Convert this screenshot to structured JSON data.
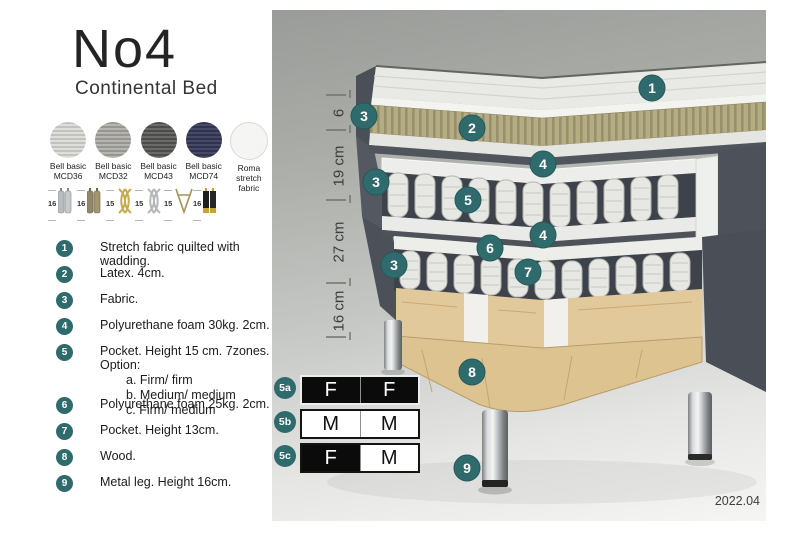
{
  "header": {
    "title": "No4",
    "subtitle": "Continental Bed"
  },
  "colors": {
    "accent_teal": "#2f6b6c",
    "panel_top_gray": "#999c98",
    "latex_khaki": "#b4ac83",
    "wood": "#dcc390",
    "bed_fabric_dark": "#4d525a"
  },
  "fabrics": [
    {
      "line1": "Bell basic",
      "line2": "MCD36",
      "color": "#d0d0cc"
    },
    {
      "line1": "Bell basic",
      "line2": "MCD32",
      "color": "#a5a5a0"
    },
    {
      "line1": "Bell basic",
      "line2": "MCD43",
      "color": "#595a57"
    },
    {
      "line1": "Bell basic",
      "line2": "MCD74",
      "color": "#3a3d58"
    },
    {
      "line1": "Roma",
      "line2": "stretch fabric",
      "color": "#f5f5f3"
    }
  ],
  "legs": [
    {
      "size": "16",
      "icon": "chrome-cylinder-legs"
    },
    {
      "size": "16",
      "icon": "bronze-cylinder-legs"
    },
    {
      "size": "15",
      "icon": "gold-twist-leg"
    },
    {
      "size": "15",
      "icon": "silver-twist-leg"
    },
    {
      "size": "15",
      "icon": "hairpin-leg"
    },
    {
      "size": "16",
      "icon": "black-gold-legs"
    }
  ],
  "callouts": [
    {
      "num": "1",
      "text": "Stretch fabric quilted with wadding."
    },
    {
      "num": "2",
      "text": "Latex. 4cm."
    },
    {
      "num": "3",
      "text": "Fabric."
    },
    {
      "num": "4",
      "text": "Polyurethane foam 30kg. 2cm."
    },
    {
      "num": "5",
      "text": "Pocket. Height 15 cm. 7zones. Option:",
      "options": [
        "a. Firm/ firm",
        "b. Medium/ medium",
        "c. Firm/ medium"
      ]
    },
    {
      "num": "6",
      "text": "Polyurethane foam 25kg. 2cm."
    },
    {
      "num": "7",
      "text": "Pocket. Height 13cm."
    },
    {
      "num": "8",
      "text": "Wood."
    },
    {
      "num": "9",
      "text": "Metal leg. Height 16cm."
    }
  ],
  "diagram": {
    "badges": {
      "b1": "1",
      "b2": "2",
      "b3": "3",
      "b4": "4",
      "b5": "5",
      "b6": "6",
      "b7": "7",
      "b8": "8",
      "b9": "9"
    },
    "dimensions": [
      "6",
      "19 cm",
      "27 cm",
      "16 cm"
    ]
  },
  "firmness": [
    {
      "label": "5a",
      "cells": [
        {
          "letter": "F"
        },
        {
          "letter": "F"
        }
      ]
    },
    {
      "label": "5b",
      "cells": [
        {
          "letter": "M"
        },
        {
          "letter": "M"
        }
      ]
    },
    {
      "label": "5c",
      "cells": [
        {
          "letter": "F"
        },
        {
          "letter": "M"
        }
      ]
    }
  ],
  "version": "2022.04"
}
